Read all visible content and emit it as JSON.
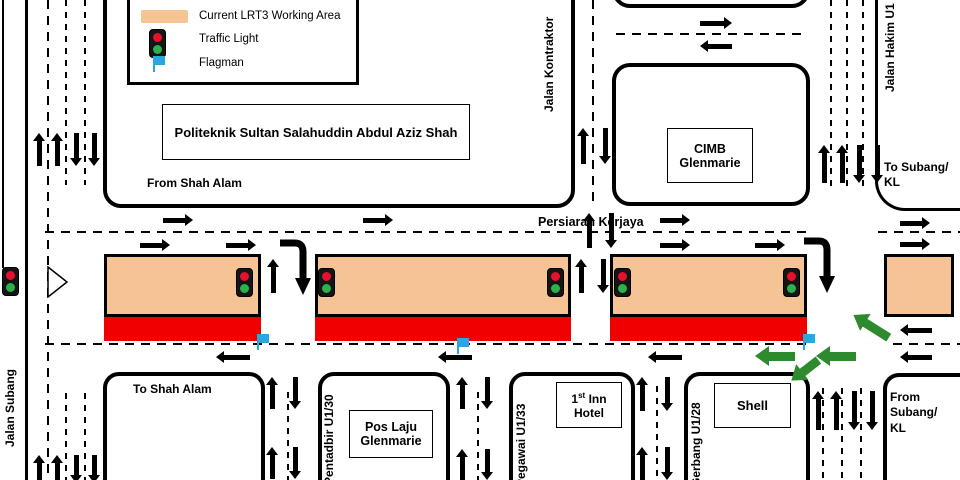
{
  "colors": {
    "working_area": "#F6C395",
    "closure_red": "#F00000",
    "flag_blue": "#29A8E0",
    "green_arrow": "#2D8A2D",
    "light_red": "#E8112D",
    "light_green": "#2BB24C"
  },
  "legend": {
    "items": [
      {
        "icon": "working-area-swatch",
        "label": "Current LRT3 Working Area"
      },
      {
        "icon": "traffic-light-icon",
        "label": "Traffic Light"
      },
      {
        "icon": "flagman-flag-icon",
        "label": "Flagman"
      }
    ]
  },
  "places": {
    "politeknik": "Politeknik Sultan Salahuddin Abdul Aziz Shah",
    "cimb": "CIMB\nGlenmarie",
    "pos_laju": "Pos Laju\nGlenmarie",
    "hotel_num": "1",
    "hotel_sup": "st",
    "hotel_rest": " Inn",
    "hotel_line2": "Hotel",
    "shell": "Shell"
  },
  "roads": {
    "persiaran_kerjaya": "Persiaran Kerjaya",
    "jalan_kontraktor": "Jalan Kontraktor",
    "jalan_hakim": "Jalan Hakim U1",
    "jalan_subang": "Jalan Subang",
    "pentadbir": "Pentadbir U1/30",
    "pegawai": "Pegawai U1/33",
    "gerbang": "Gerbang U1/28"
  },
  "directions": {
    "from_shah_alam": "From Shah Alam",
    "to_shah_alam": "To Shah Alam",
    "to_subang_kl": "To Subang/\nKL",
    "from_subang_kl": "From\nSubang/\nKL"
  }
}
